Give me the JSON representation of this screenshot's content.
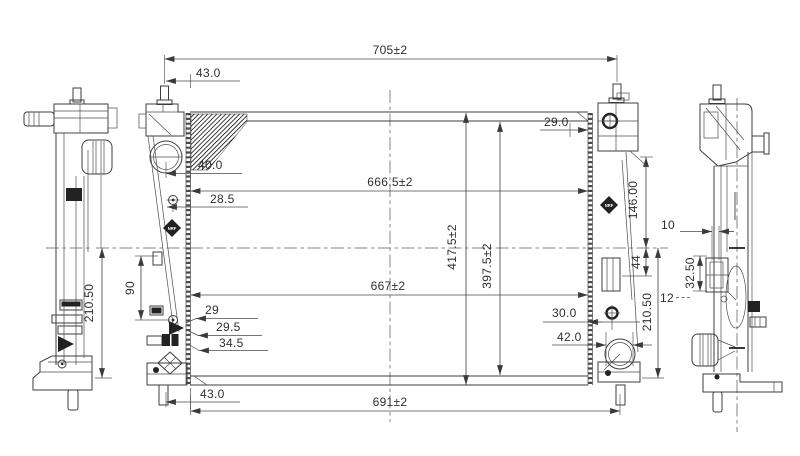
{
  "dimensions": {
    "overall_width": "705±2",
    "top_left_offset": "43.0",
    "top_right_offset": "29.0",
    "core_width_top": "666.5±2",
    "core_width_bottom": "667±2",
    "core_height": "417.5±2",
    "core_height_inner": "397.5±2",
    "filler_offset": "40.0",
    "upper_bolt_offset": "28.5",
    "left_tab_span": "90",
    "lower_left_offset_1": "29",
    "lower_left_offset_2": "29.5",
    "lower_left_offset_3": "34.5",
    "bottom_left_offset": "43.0",
    "bottom_width": "691±2",
    "right_bracket_drop": "146.00",
    "right_tab_height": "44",
    "drain_offset": "30.0",
    "outlet_diameter": "42.0",
    "right_mount_height": "210.50",
    "left_mount_height": "210.50",
    "clip_offset": "10",
    "clip_height": "32.50",
    "clip_gap": "12"
  },
  "logo": {
    "brand_mark": "NRF"
  }
}
